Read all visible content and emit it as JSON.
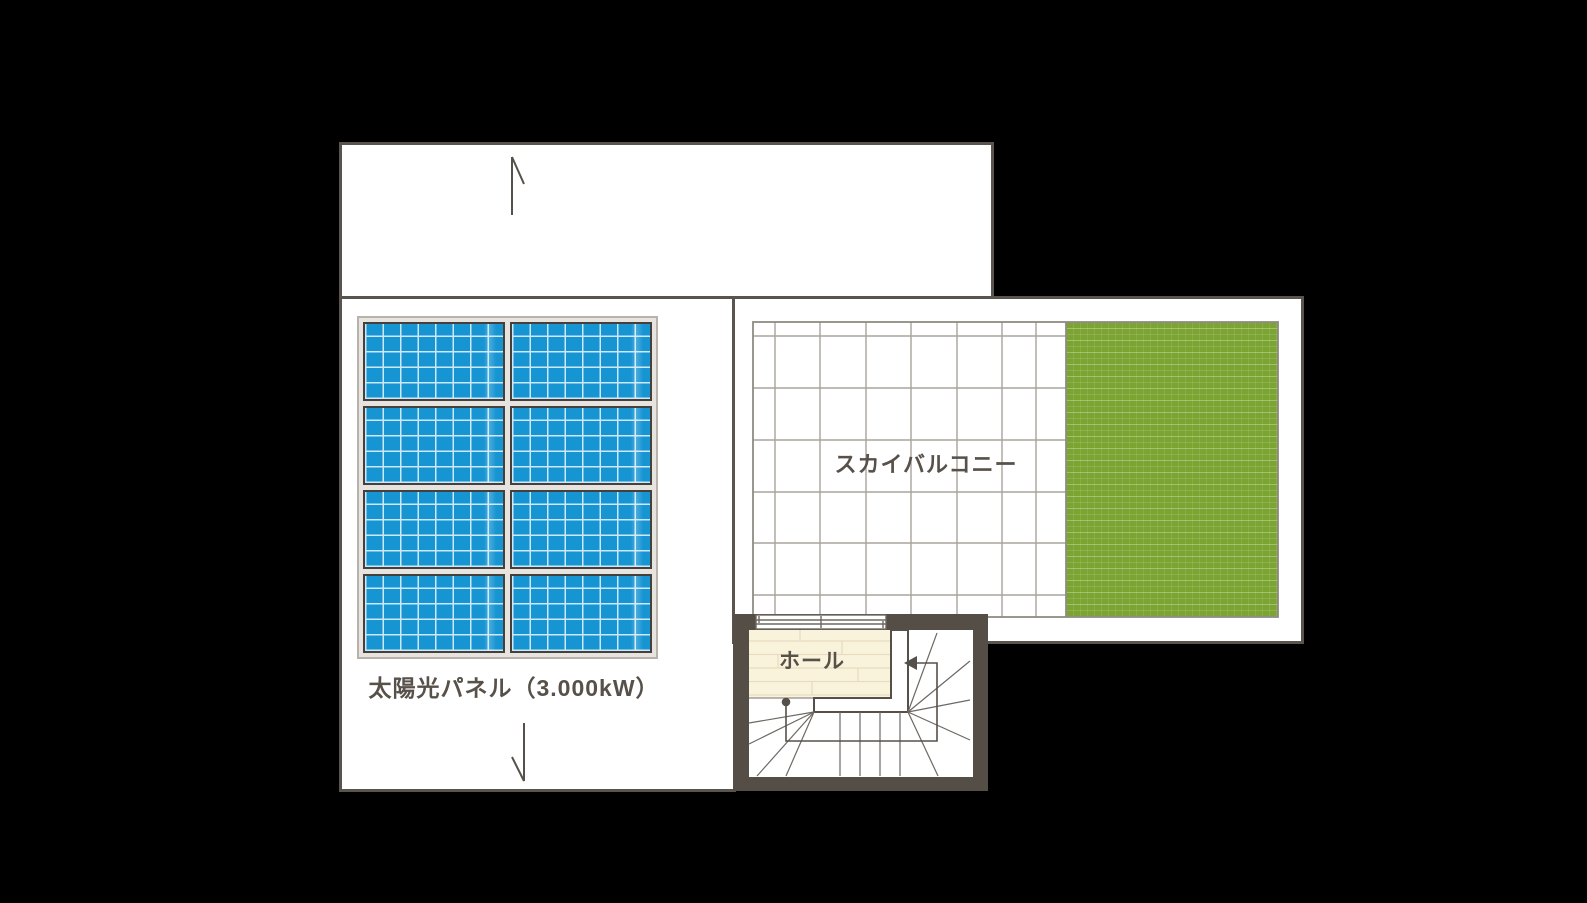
{
  "title": "rooftop-floor-plan",
  "labels": {
    "solar_panel": "太陽光パネル（3.000kW）",
    "sky_balcony": "スカイバルコニー",
    "hall": "ホール"
  },
  "solar": {
    "rows": 4,
    "cols": 2,
    "panel_count": 8
  },
  "icons": {
    "slope_arrow_up": "half-arrow pointing up (top roof area)",
    "slope_arrow_down": "half-arrow pointing down (bottom roof area)",
    "stair_walk_arrow": "stair walk line with dot start and left-pointing arrowhead"
  },
  "colors": {
    "background": "#000000",
    "room_outline": "#5a544e",
    "wall_dark": "#544e46",
    "panel_blue": "#1795d3",
    "panel_grid_line": "#cde8f6",
    "grass_green": "#7ba432",
    "deck_tile_line": "#a9a39d",
    "hall_floor": "#faf3dc",
    "hall_plank_line": "#e6dcbf",
    "text": "#57514a"
  }
}
